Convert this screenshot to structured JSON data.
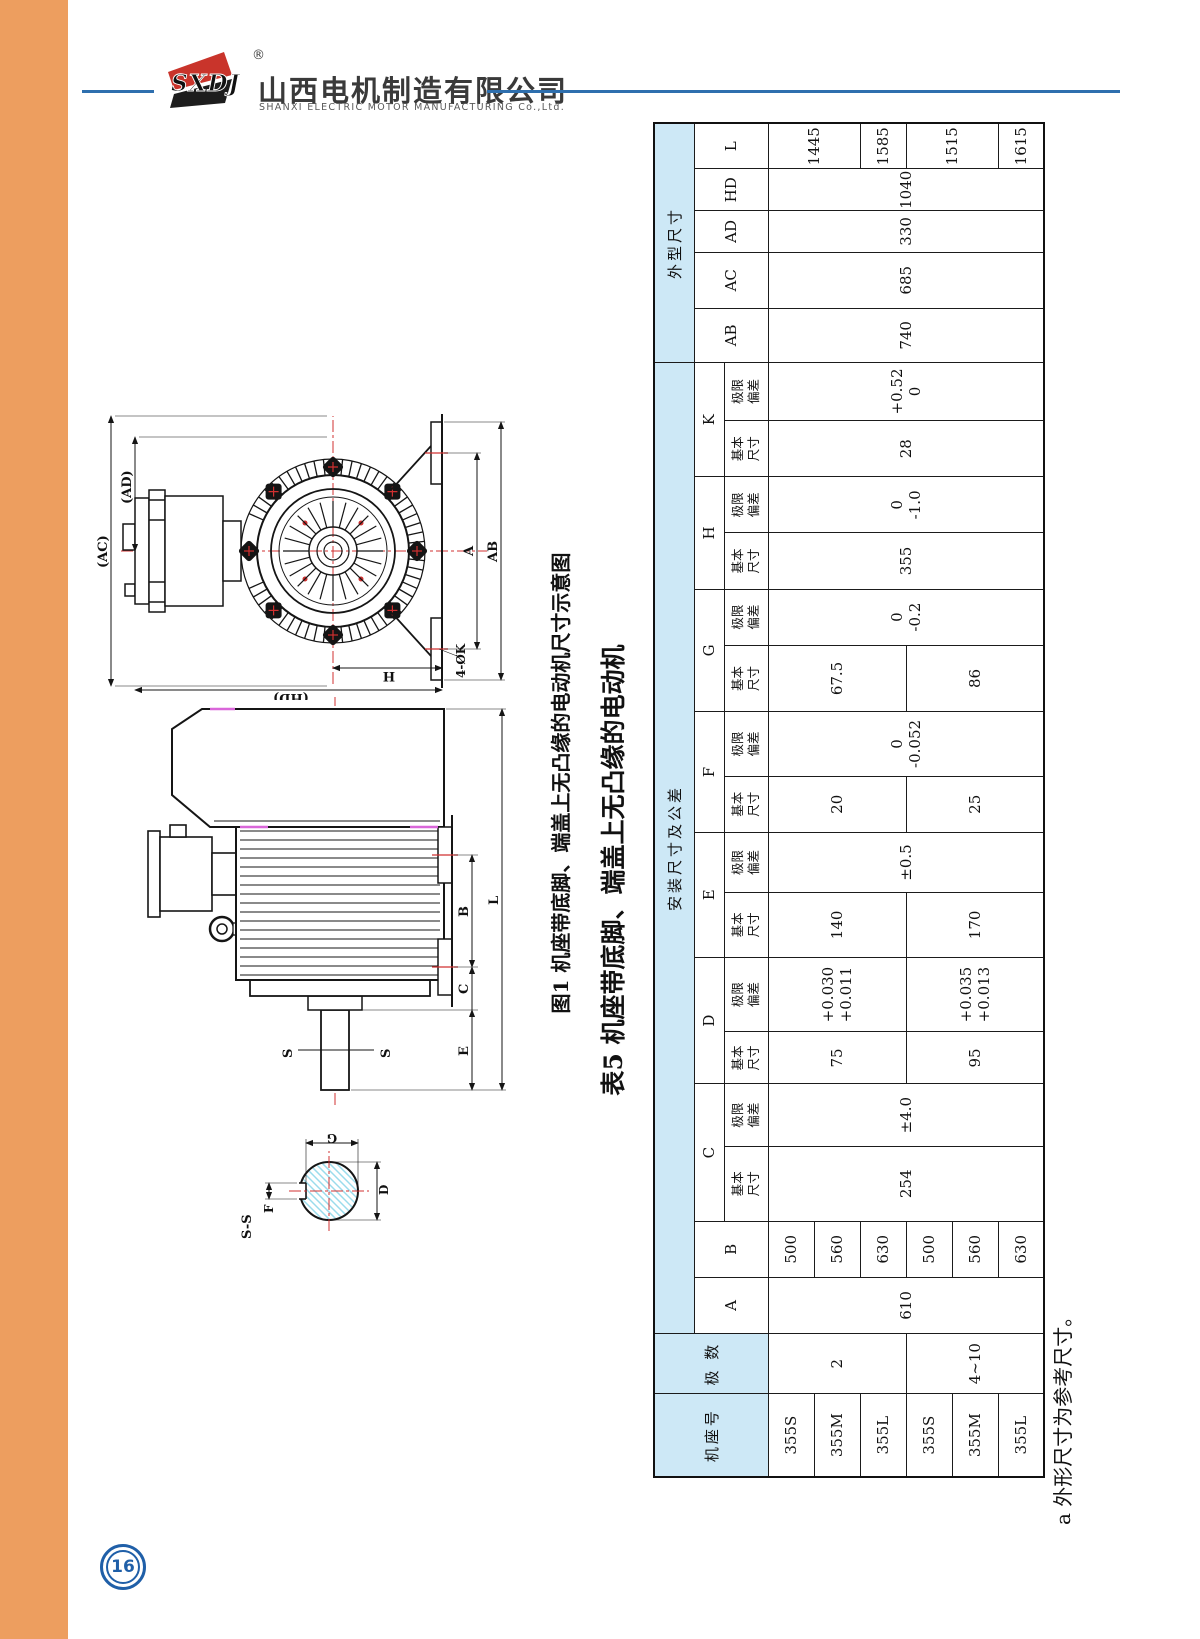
{
  "page": {
    "number": "16"
  },
  "header": {
    "logo_text": "SXDJ",
    "registered": "®",
    "company_cn": "山西电机制造有限公司",
    "company_en": "SHANXI ELECTRIC MOTOR MANUFACTURING Co.,Ltd."
  },
  "figure": {
    "caption": "图1 机座带底脚、端盖上无凸缘的电动机尺寸示意图",
    "labels": {
      "ac": "(AC)",
      "ad": "(AD)",
      "hd": "(HD)",
      "h": "H",
      "a": "A",
      "ab": "AB",
      "k4": "4-ØK",
      "b": "B",
      "c": "C",
      "e": "E",
      "l": "L",
      "s": "S",
      "ss": "S-S",
      "f": "F",
      "g": "G",
      "d": "D"
    }
  },
  "table": {
    "caption": "表5 机座带底脚、端盖上无凸缘的电动机",
    "footnote": "a 外形尺寸为参考尺寸。",
    "group": {
      "install": "安装尺寸及公差",
      "outline": "外型尺寸"
    },
    "head": {
      "frame": "机座号",
      "poles": "极 数",
      "basic": "基本尺寸",
      "dev": "极限偏差",
      "A": "A",
      "B": "B",
      "C": "C",
      "D": "D",
      "E": "E",
      "F": "F",
      "G": "G",
      "H": "H",
      "K": "K",
      "AB": "AB",
      "AC": "AC",
      "AD": "AD",
      "HD": "HD",
      "L": "L"
    },
    "frames": [
      "355S",
      "355M",
      "355L",
      "355S",
      "355M",
      "355L"
    ],
    "poles": [
      "2",
      "4~10"
    ],
    "A": "610",
    "B": [
      "500",
      "560",
      "630",
      "500",
      "560",
      "630"
    ],
    "C": {
      "basic": "254",
      "dev": "±4.0"
    },
    "D": {
      "basic": [
        "75",
        "95"
      ],
      "dev": [
        [
          "+0.030",
          "+0.011"
        ],
        [
          "+0.035",
          "+0.013"
        ]
      ]
    },
    "E": {
      "basic": [
        "140",
        "170"
      ],
      "dev": "±0.5"
    },
    "F": {
      "basic": [
        "20",
        "25"
      ],
      "dev": [
        "0",
        "-0.052"
      ]
    },
    "G": {
      "basic": [
        "67.5",
        "86"
      ],
      "dev": [
        "0",
        "-0.2"
      ]
    },
    "H": {
      "basic": "355",
      "dev": [
        "0",
        "-1.0"
      ]
    },
    "K": {
      "basic": "28",
      "dev": [
        "+0.52",
        "0"
      ]
    },
    "AB": "740",
    "AC": "685",
    "AD": "330",
    "HD": "1040",
    "L": [
      "1445",
      "1585",
      "1515",
      "1615"
    ]
  }
}
